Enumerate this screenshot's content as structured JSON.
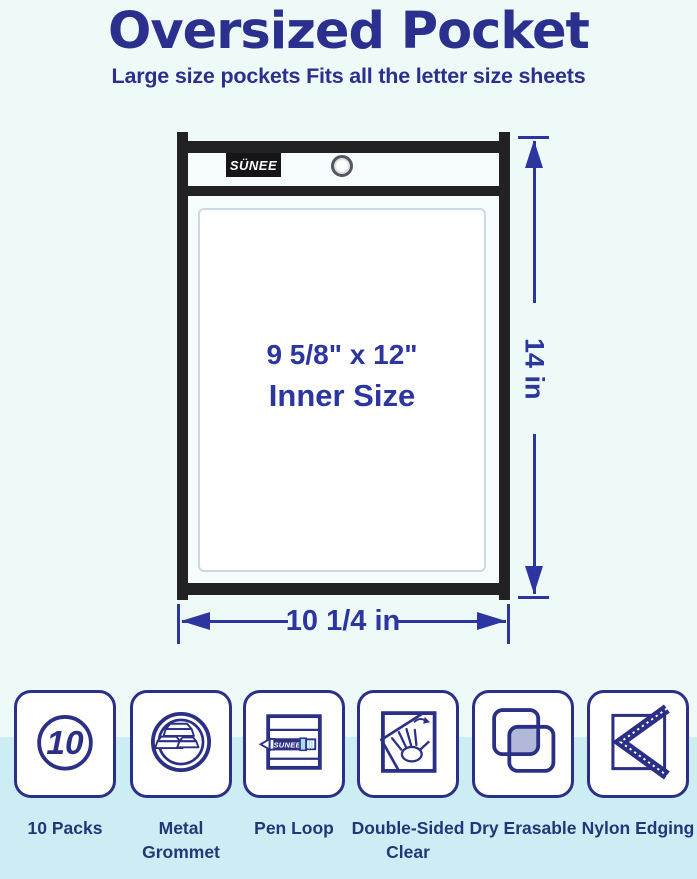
{
  "colors": {
    "page_bg": "#eefaf8",
    "band_bg": "#cdedf4",
    "navy": "#2b2f8e",
    "blue": "#2c35a0",
    "label_navy": "#233679",
    "icon_navy": "#2b3086",
    "frame_black": "#222224",
    "pocket_bg": "#f6fbfd",
    "sheet_border": "#ccd9e2",
    "lavender": "#b2b8d9",
    "marker_cyan": "#a5dcec",
    "grommet_gray": "#54585d"
  },
  "header": {
    "title": "Oversized Pocket",
    "subtitle": "Large size pockets Fits all the letter size sheets"
  },
  "pocket": {
    "brand": "SÜNEE",
    "inner_size_line1": "9 5/8\" x 12\"",
    "inner_size_line2": "Inner Size"
  },
  "dimensions": {
    "height": "14 in",
    "width": "10 1/4 in"
  },
  "features": [
    {
      "label_line1": "10 Packs",
      "label_line2": "",
      "badge": "10"
    },
    {
      "label_line1": "Metal",
      "label_line2": "Grommet"
    },
    {
      "label_line1": "Pen Loop",
      "label_line2": "",
      "pen_text": "SUNEE"
    },
    {
      "label_line1": "Double-Sided",
      "label_line2": "Clear"
    },
    {
      "label_line1": "Dry Erasable",
      "label_line2": ""
    },
    {
      "label_line1": "Nylon Edging",
      "label_line2": ""
    }
  ]
}
